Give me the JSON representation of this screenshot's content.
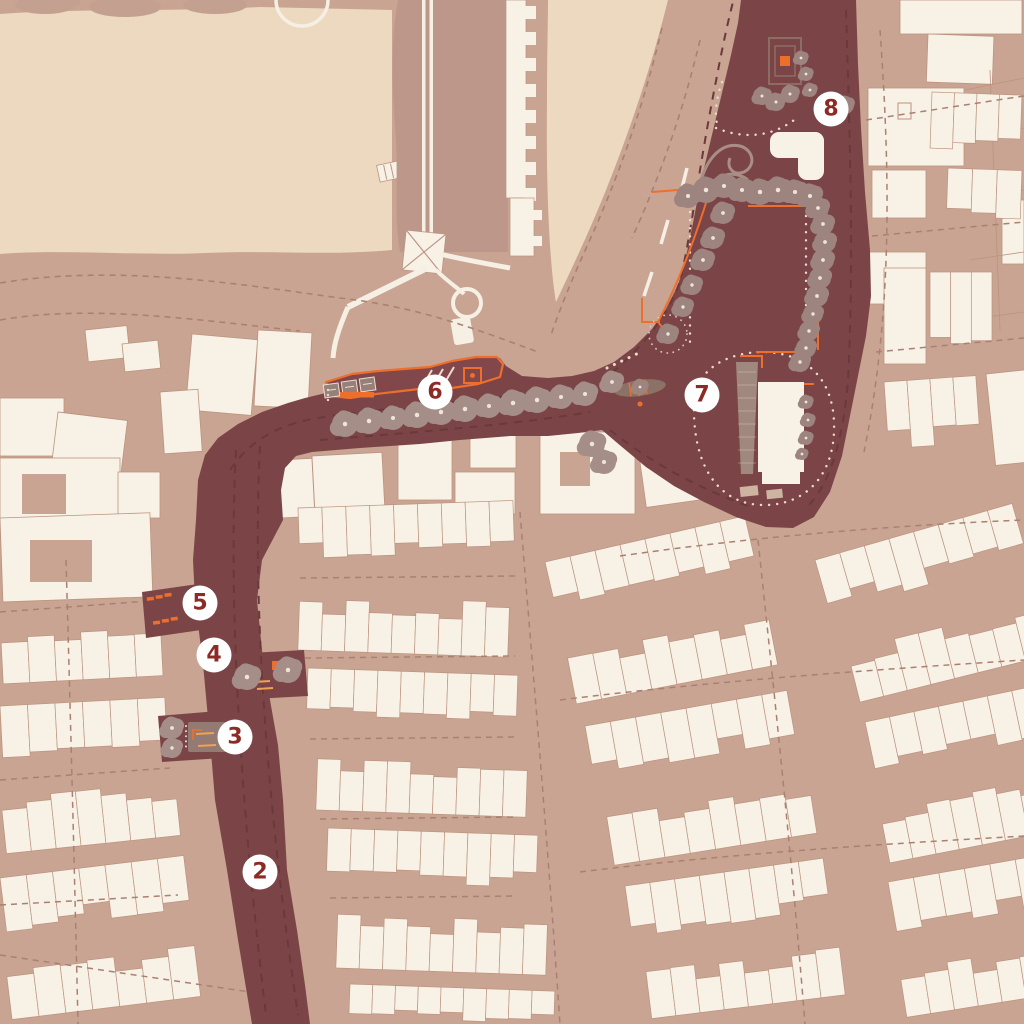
{
  "map": {
    "markers": [
      {
        "label": "2",
        "x": 260,
        "y": 872
      },
      {
        "label": "3",
        "x": 235,
        "y": 737
      },
      {
        "label": "4",
        "x": 214,
        "y": 655
      },
      {
        "label": "5",
        "x": 200,
        "y": 603
      },
      {
        "label": "6",
        "x": 435,
        "y": 392
      },
      {
        "label": "7",
        "x": 702,
        "y": 395
      },
      {
        "label": "8",
        "x": 831,
        "y": 109
      }
    ],
    "colors": {
      "base": "#c9a492",
      "open_space": "#ecd9c0",
      "castle_ground": "#bd978a",
      "building": "#f8f1e5",
      "building_outline": "#bc9480",
      "route": "#7b4547",
      "route_lane": "#6b393b",
      "accent_orange": "#ee6e2c",
      "accent_yellow": "#f0a24e",
      "tree_street": "#a58e88",
      "tree_park": "#9d847e",
      "tree_dot": "#eee4d8",
      "white_path": "#f6efe3",
      "street_dash": "#aa8170",
      "dotted_path": "#eadccc",
      "plaza_gray": "#9b817a",
      "marker_bg": "#ffffff",
      "marker_text": "#8e2a26"
    }
  }
}
